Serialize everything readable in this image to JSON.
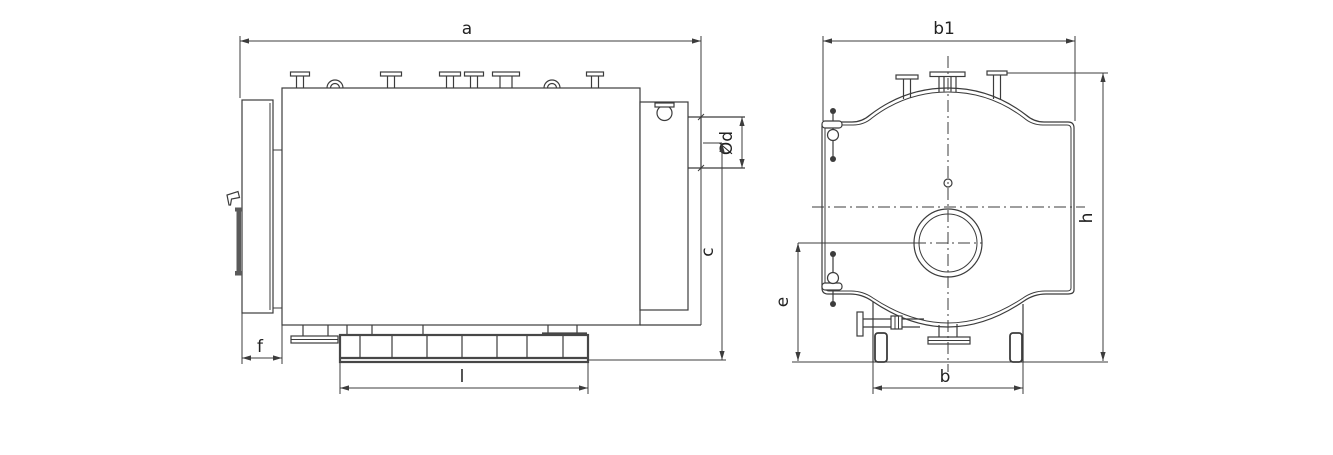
{
  "drawing": {
    "background_color": "#ffffff",
    "line_color": "#3c3c3c",
    "dimension_labels": {
      "a": "a",
      "b1": "b1",
      "diameter_d": "Ød",
      "c": "c",
      "e": "e",
      "f": "f",
      "l": "l",
      "b": "b",
      "h": "h"
    }
  }
}
